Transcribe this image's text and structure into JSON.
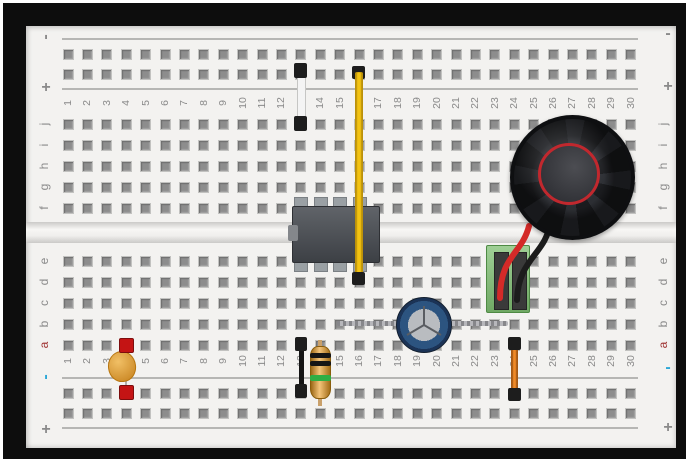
{
  "board": {
    "column_numbers": [
      "1",
      "2",
      "3",
      "4",
      "5",
      "6",
      "7",
      "8",
      "9",
      "10",
      "11",
      "12",
      "13",
      "14",
      "15",
      "16",
      "17",
      "18",
      "19",
      "20",
      "21",
      "22",
      "23",
      "24",
      "25",
      "26",
      "27",
      "28",
      "29",
      "30"
    ],
    "row_letters_top": [
      "j",
      "i",
      "h",
      "g",
      "f"
    ],
    "row_letters_bottom": [
      "e",
      "d",
      "c",
      "b",
      "a"
    ],
    "markers": {
      "top_left_minus": "-",
      "top_left_plus": "+",
      "top_right_minus": "-",
      "top_right_plus": "+",
      "bottom_left_minus": "-",
      "bottom_left_plus": "+",
      "bottom_right_minus": "-",
      "bottom_right_plus": "+"
    },
    "colors": {
      "board": "#f3f2f0",
      "hole": "#8d8d8d",
      "labels": "#8a8a8a",
      "row_a_label": "#a03434",
      "negative_marker": "#2ba7d6",
      "frame": "#0d0d0d"
    }
  },
  "components": {
    "white_jumper": {
      "type": "jumper-wire",
      "color": "#f4f4f4",
      "column": "13",
      "connects": "plus rail to row j"
    },
    "yellow_jumper": {
      "type": "jumper-wire",
      "color": "#f3c312",
      "column": "16",
      "connects": "plus rail to row d"
    },
    "ic_chip": {
      "type": "8-pin-dip-ic",
      "color": "#4a4e54",
      "columns": "13-16",
      "rows": "e-f"
    },
    "speaker": {
      "type": "speaker",
      "color": "#17181b",
      "cone_ring_color": "#c1282e",
      "columns": "24-30"
    },
    "terminal_block": {
      "type": "screw-terminal-2pin",
      "color": "#7fbf72",
      "columns": "23-24",
      "rows": "c-e"
    },
    "speaker_wire_red": {
      "type": "wire",
      "color": "#d42a28"
    },
    "speaker_wire_black": {
      "type": "wire",
      "color": "#1c1c1c"
    },
    "electrolytic_capacitor": {
      "type": "electrolytic-capacitor",
      "color": "#274b78",
      "columns": "15-23",
      "row": "b"
    },
    "ceramic_capacitor": {
      "type": "ceramic-capacitor",
      "color": "#e0911f",
      "column": "4",
      "connects": "row a to minus rail",
      "pin_marker_color": "#c41414"
    },
    "black_jumper": {
      "type": "jumper-wire",
      "color": "#141414",
      "column": "13",
      "connects": "row a to minus rail"
    },
    "resistor": {
      "type": "resistor",
      "body_color": "#eda432",
      "bands": [
        "black",
        "black",
        "green"
      ],
      "band_colors": [
        "#151515",
        "#151515",
        "#2fae44"
      ],
      "column": "14",
      "connects": "row a to minus rail"
    },
    "orange_jumper": {
      "type": "jumper-wire",
      "color": "#f08a28",
      "column": "24",
      "connects": "row a to minus rail"
    }
  }
}
